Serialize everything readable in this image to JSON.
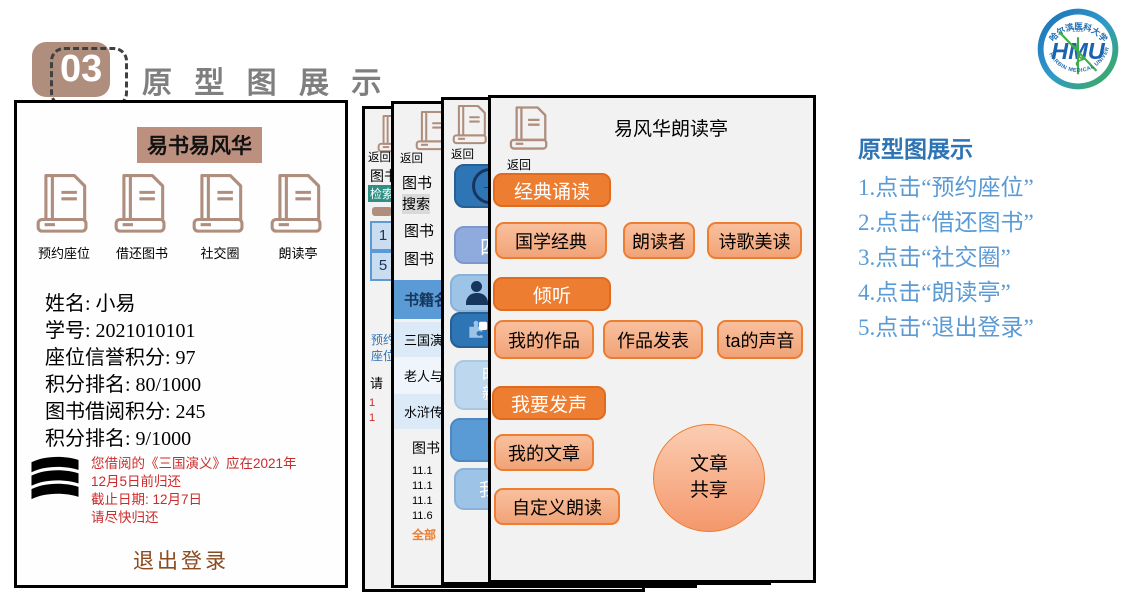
{
  "slide": {
    "number": "03",
    "title": "原 型 图 展 示"
  },
  "logo": {
    "abbr": "HMU",
    "top_arc": "哈尔滨医科大学",
    "bottom_arc": "HARBIN MEDICAL UNIVERSITY",
    "year": "1926"
  },
  "colors": {
    "accent_orange": "#ED7D31",
    "accent_salmon": "#F4B183",
    "accent_blue": "#5B9BD5",
    "accent_tan": "#B08E7E",
    "alert_red": "#CC2B2B",
    "logout_brown": "#8C4A1E",
    "title_gray": "#7F7F7F",
    "heading_blue": "#2E74B5"
  },
  "home_screen": {
    "title": "易书易风华",
    "menu": [
      {
        "label": "预约座位"
      },
      {
        "label": "借还图书"
      },
      {
        "label": "社交圈"
      },
      {
        "label": "朗读亭"
      }
    ],
    "profile": [
      "姓名: 小易",
      "学号: 2021010101",
      "座位信誉积分: 97",
      "积分排名: 80/1000",
      "图书借阅积分: 245",
      "积分排名: 9/1000"
    ],
    "notice": [
      "您借阅的《三国演义》应在2021年",
      "12月5日前归还",
      "截止日期: 12月7日",
      "请尽快归还"
    ],
    "logout": "退出登录"
  },
  "seat_screen": {
    "back": "返回",
    "line1": "图书",
    "search": "检索",
    "cell1": "1",
    "cell2": "5",
    "blue1": "预约",
    "blue2": "座位",
    "note": "请",
    "red1": "1",
    "red2": "1"
  },
  "book_screen": {
    "back": "返回",
    "line1": "图书",
    "search": "搜索",
    "line2": "图书",
    "line3": "图书",
    "table_header": "书籍名",
    "rows": [
      "三国演",
      "老人与",
      "水浒传"
    ],
    "caption": "图书",
    "dates": [
      "11.1",
      "11.1",
      "11.1",
      "11.6"
    ],
    "more": "全部"
  },
  "social_screen": {
    "back": "返回",
    "btn_level": "四",
    "btn_me": "我",
    "btn_puzzle": "精",
    "btn_news_line1": "时",
    "btn_news_line2": "新",
    "btn_my": "我"
  },
  "reading_screen": {
    "back": "返回",
    "title": "易风华朗读亭",
    "btn_classic": "经典诵读",
    "btn_guoxue": "国学经典",
    "btn_reader": "朗读者",
    "btn_poetry": "诗歌美读",
    "btn_listen": "倾听",
    "btn_my_works": "我的作品",
    "btn_publish": "作品发表",
    "btn_ta_voice": "ta的声音",
    "btn_speak": "我要发声",
    "btn_my_article": "我的文章",
    "btn_custom": "自定义朗读",
    "circle_line1": "文章",
    "circle_line2": "共享"
  },
  "instructions": {
    "title": "原型图展示",
    "items": [
      "1.点击“预约座位”",
      "2.点击“借还图书”",
      "3.点击“社交圈”",
      "4.点击“朗读亭”",
      "5.点击“退出登录”"
    ]
  }
}
